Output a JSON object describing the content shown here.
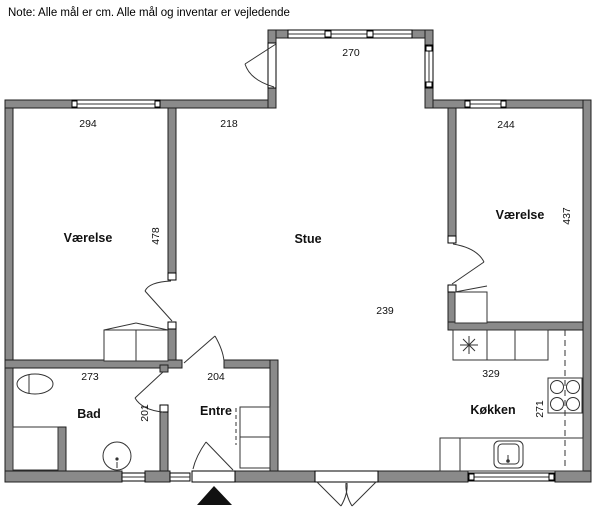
{
  "note": "Note: Alle mål er cm. Alle mål og inventar er vejledende",
  "colors": {
    "wall_fill": "#8a8a8a",
    "wall_outline": "#1f1f1f",
    "background": "#ffffff",
    "marker": "#111111"
  },
  "rooms": {
    "bedroom_left": "Værelse",
    "living_room": "Stue",
    "bedroom_right": "Værelse",
    "bathroom": "Bad",
    "entry": "Entre",
    "kitchen": "Køkken"
  },
  "dimensions": {
    "bedroom_left_width": "294",
    "hall_top_width": "218",
    "bumpout_window_width": "270",
    "bedroom_right_width": "244",
    "bedroom_left_depth": "478",
    "bedroom_right_depth": "437",
    "bathroom_width": "273",
    "entry_width": "204",
    "bathroom_depth": "201",
    "living_room_width": "239",
    "kitchen_width": "329",
    "kitchen_depth": "271"
  }
}
